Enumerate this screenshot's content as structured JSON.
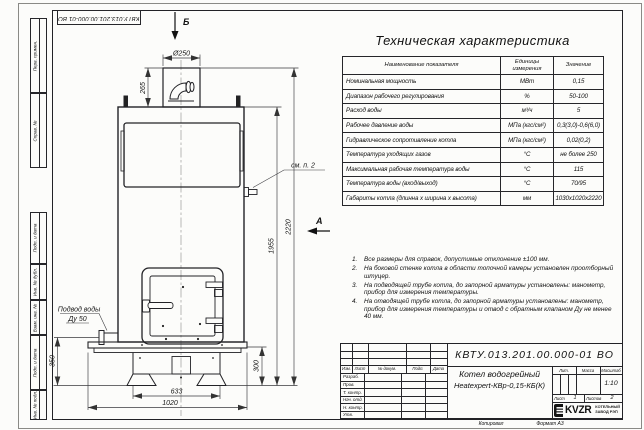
{
  "sheet": {
    "copied_label": "Копировал",
    "format_label": "Формат А3"
  },
  "frame_stamps": {
    "top_doc_number": "КВТУ.013.201.00.000-01 ВО",
    "left_labels": [
      "Перв. примен.",
      "Справ. №",
      "Подп. и дата",
      "Инв. № дубл.",
      "Взам. инв. №",
      "Подп. и дата",
      "Инв. № подл."
    ]
  },
  "drawing": {
    "view_b": "Б",
    "view_a": "А",
    "note_ref": "см. п. 2",
    "inlet_line1": "Подвод воды",
    "inlet_line2": "Ду 50",
    "dims": {
      "chimney_dia": "Ø250",
      "chimney_height": "265",
      "inlet_height": "350",
      "feet_width": "633",
      "base_width": "1020",
      "base_height": "300",
      "body_height": "1955",
      "total_height": "2220"
    }
  },
  "spec_table": {
    "title": "Техническая характеристика",
    "headers": [
      "Наименование показателя",
      "Единицы измерения",
      "Значение"
    ],
    "rows": [
      [
        "Номинальная мощность",
        "МВт",
        "0,15"
      ],
      [
        "Диапазон рабочего регулирования",
        "%",
        "50-100"
      ],
      [
        "Расход воды",
        "м³/ч",
        "5"
      ],
      [
        "Рабочее давление воды",
        "МПа (кгс/см²)",
        "0,3(3,0)-0,6(6,0)"
      ],
      [
        "Гидравлическое сопротивление котла",
        "МПа (кгс/см²)",
        "0,02(0,2)"
      ],
      [
        "Температура уходящих газов",
        "°С",
        "не более 250"
      ],
      [
        "Максимальная рабочая температура воды",
        "°С",
        "115"
      ],
      [
        "Температура воды (вход/выход)",
        "°С",
        "70/95"
      ],
      [
        "Габариты котла (длинна х ширина х высота)",
        "мм",
        "1030х1020х2220"
      ]
    ]
  },
  "notes": [
    {
      "num": "1.",
      "text": "Все размеры для справок, допустимые отклонение ±100 мм."
    },
    {
      "num": "2.",
      "text": "На боковой стенке котла в области топочной камеры установлен проотборный штуцер."
    },
    {
      "num": "3.",
      "text": "На подводящей трубе котла, до запорной арматуры установлены: манометр, прибор для измерения температуры."
    },
    {
      "num": "4.",
      "text": "На отводящей трубе котла, до запорной арматуры установлены: манометр, прибор для измерения температуры и отвод с обратным клапаном Ду не менее 40 мм."
    }
  ],
  "title_block": {
    "doc_number": "КВТУ.013.201.00.000-01 ВО",
    "name_line1": "Котел водогрейный",
    "name_line2": "Heatexpert-КВр-0,15-КБ(К)",
    "rev_headers": [
      "Изм.",
      "Лист",
      "№ докум.",
      "Подп.",
      "Дата"
    ],
    "role_rows": [
      "Разраб.",
      "Пров.",
      "Т. контр.",
      "Нач. отд.",
      "Н. контр.",
      "Утв."
    ],
    "lit_label": "Лит.",
    "mass_label": "Масса",
    "scale_label": "Масштаб",
    "scale_value": "1:10",
    "sheet_label": "Лист",
    "sheet_value": "1",
    "sheets_label": "Листов",
    "sheets_value": "2",
    "company": {
      "logo_text": "KVZR",
      "line1": "КОТЕЛЬНЫЙ",
      "line2": "ЗАВОД  РЭП"
    }
  }
}
